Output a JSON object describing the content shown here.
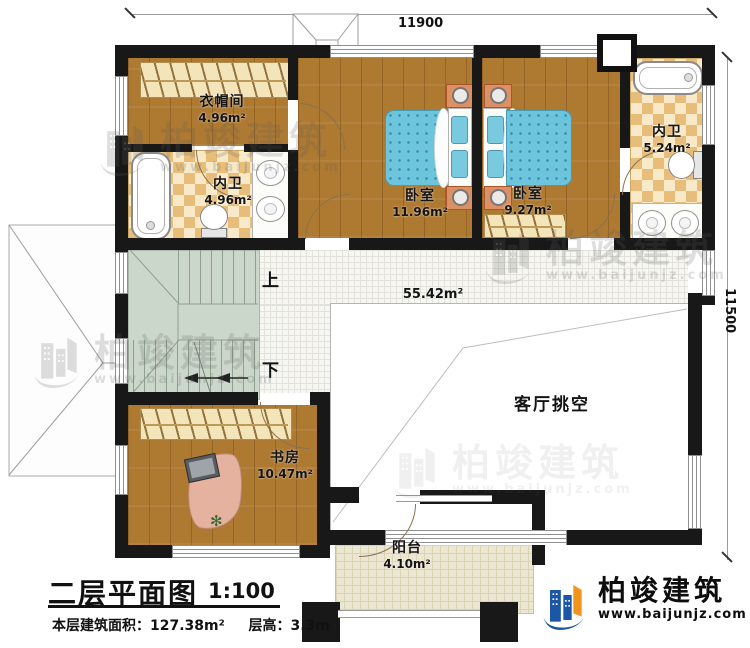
{
  "dimensions": {
    "top": "11900",
    "right": "11500"
  },
  "rooms": {
    "cloakroom": {
      "name": "衣帽间",
      "area": "4.96m²"
    },
    "bath_left": {
      "name": "内卫",
      "area": "4.96m²"
    },
    "bedroom_main": {
      "name": "卧室",
      "area": "11.96m²"
    },
    "bedroom_second": {
      "name": "卧室",
      "area": "9.27m²"
    },
    "bath_right": {
      "name": "内卫",
      "area": "5.24m²"
    },
    "study": {
      "name": "书房",
      "area": "10.47m²"
    },
    "balcony": {
      "name": "阳台",
      "area": "4.10m²"
    },
    "hall": {
      "area": "55.42m²"
    },
    "living_void": {
      "name": "客厅挑空"
    }
  },
  "stairs": {
    "up_label": "上",
    "down_label": "下"
  },
  "title_block": {
    "title": "二层平面图",
    "scale": "1:100",
    "area_label": "本层建筑面积：",
    "area_value": "127.38m²",
    "height_label": "层高：",
    "height_value": "3.3m"
  },
  "brand": {
    "name": "柏竣建筑",
    "website": "www.baijunjz.com"
  },
  "watermark": {
    "name": "柏竣建筑",
    "website": "www.baijunjz.com"
  },
  "colors": {
    "wall": "#181818",
    "wood_floor": "#ae7931",
    "bed": "#6cc4dd",
    "tile_checker": "#e7bd79",
    "stairs": "#cbd7cb",
    "balcony": "#ebe7d2",
    "brand_blue": "#1b57a5",
    "brand_orange": "#f0941d"
  }
}
